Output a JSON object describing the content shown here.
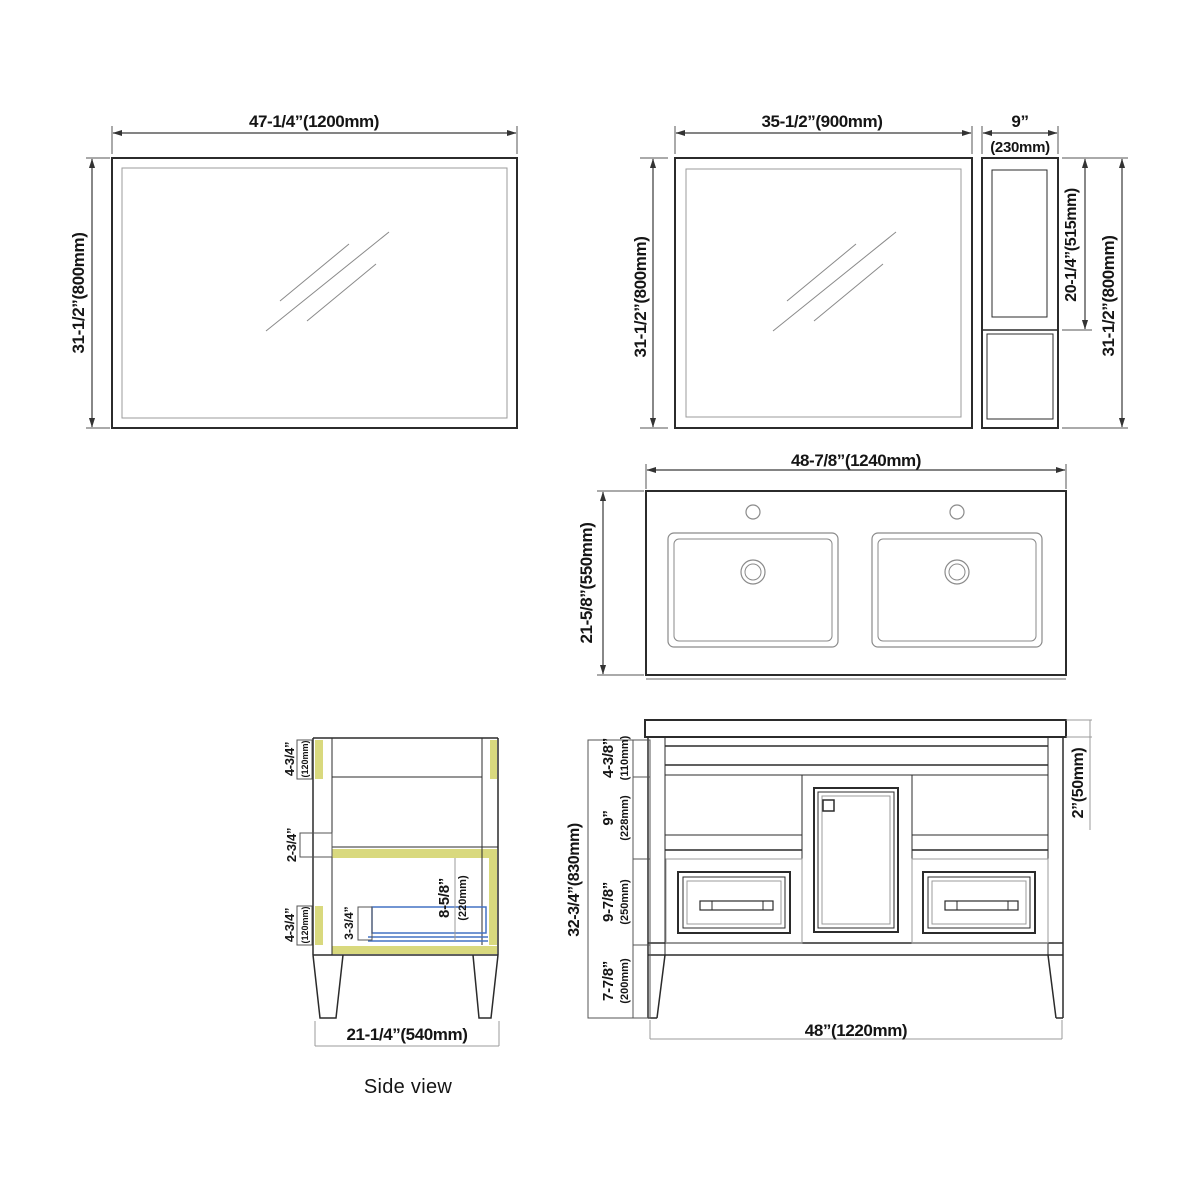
{
  "colors": {
    "line": "#2b2b2b",
    "gray": "#9b9b9b",
    "highlight_olive": "#d9d97e",
    "drawer_blue": "#4472c4"
  },
  "mirror_left": {
    "width": "47-1/4”(1200mm)",
    "height": "31-1/2”(800mm)"
  },
  "mirror_right": {
    "mirror_width": "35-1/2”(900mm)",
    "cabinet_width_in": "9”",
    "cabinet_width_mm": "(230mm)",
    "height_left": "31-1/2”(800mm)",
    "cabinet_door_height": "20-1/4”(515mm)",
    "height_right": "31-1/2”(800mm)"
  },
  "sink_top": {
    "width": "48-7/8”(1240mm)",
    "depth": "21-5/8”(550mm)"
  },
  "side_view": {
    "caption": "Side view",
    "top_frame_in": "4-3/4”",
    "top_frame_mm": "(120mm)",
    "mid_rail_in": "2-3/4”",
    "bottom_frame_in": "4-3/4”",
    "bottom_frame_mm": "(120mm)",
    "drawer_front_in": "3-3/4”",
    "drawer_inner_in": "8-5/8”",
    "drawer_inner_mm": "(220mm)",
    "depth": "21-1/4”(540mm)"
  },
  "front_view": {
    "overall_height": "32-3/4”(830mm)",
    "sections": [
      {
        "in": "4-3/8”",
        "mm": "(110mm)"
      },
      {
        "in": "9”",
        "mm": "(228mm)"
      },
      {
        "in": "9-7/8”",
        "mm": "(250mm)"
      },
      {
        "in": "7-7/8”",
        "mm": "(200mm)"
      }
    ],
    "countertop_thickness": "2”(50mm)",
    "width": "48”(1220mm)"
  }
}
